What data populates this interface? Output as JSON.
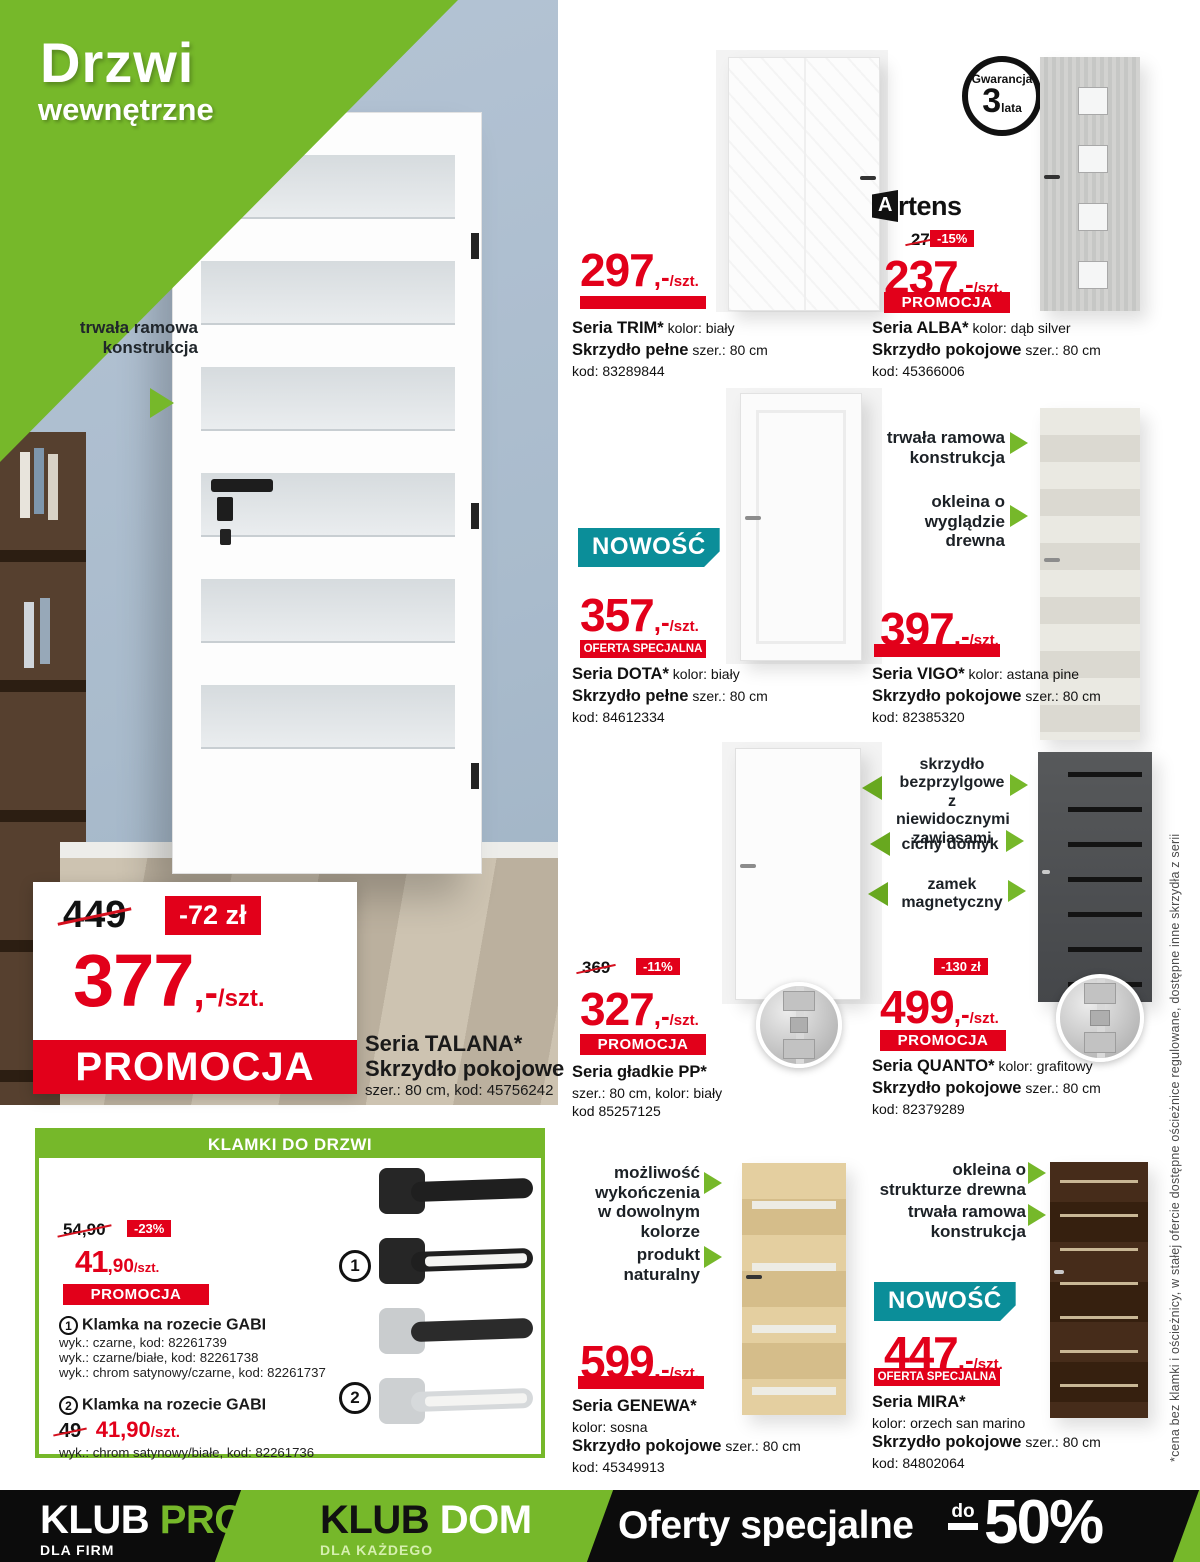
{
  "title": {
    "line1": "Drzwi",
    "line2": "wewnętrzne"
  },
  "colors": {
    "green": "#76B82A",
    "red": "#E2001A",
    "teal": "#0B8E99",
    "wall": "#AEBFD3",
    "footer": "#0C0C0C"
  },
  "hero": {
    "callout": "trwała ramowa konstrukcja",
    "old_price": "449",
    "discount": "-72 zł",
    "price": {
      "amount": "377",
      "dash": ",-",
      "unit": "/szt."
    },
    "promo_label": "PROMOCJA",
    "series": "Seria TALANA*",
    "series_line2": "Skrzydło pokojowe",
    "series_line3": "szer.: 80 cm, kod: 45756242"
  },
  "guarantee": {
    "top": "Gwarancja",
    "num": "3",
    "bottom": "lata"
  },
  "brand": {
    "mark": "A",
    "name": "rtens"
  },
  "products": {
    "trim": {
      "price": {
        "amount": "297",
        "dash": ",-",
        "unit": "/szt."
      },
      "l1b": "Seria TRIM*",
      "l1": "kolor: biały",
      "l2b": "Skrzydło pełne",
      "l2": "szer.: 80 cm",
      "l3": "kod: 83289844"
    },
    "alba": {
      "old": "279",
      "disc": "-15%",
      "price": {
        "amount": "237",
        "dash": ",-",
        "unit": "/szt."
      },
      "badge": "PROMOCJA",
      "l1b": "Seria ALBA*",
      "l1": "kolor: dąb silver",
      "l2b": "Skrzydło pokojowe",
      "l2": "szer.: 80 cm",
      "l3": "kod: 45366006"
    },
    "dota": {
      "new": "NOWOŚĆ",
      "price": {
        "amount": "357",
        "dash": ",-",
        "unit": "/szt."
      },
      "badge": "OFERTA SPECJALNA",
      "l1b": "Seria DOTA*",
      "l1": "kolor: biały",
      "l2b": "Skrzydło pełne",
      "l2": "szer.: 80 cm",
      "l3": "kod: 84612334"
    },
    "vigo": {
      "callout1": "trwała ramowa konstrukcja",
      "callout2": "okleina o wyglądzie drewna",
      "price": {
        "amount": "397",
        "dash": ",-",
        "unit": "/szt."
      },
      "l1b": "Seria VIGO*",
      "l1": "kolor: astana pine",
      "l2b": "Skrzydło pokojowe",
      "l2": "szer.: 80 cm",
      "l3": "kod: 82385320"
    },
    "pp": {
      "old": "369",
      "disc": "-11%",
      "price": {
        "amount": "327",
        "dash": ",-",
        "unit": "/szt."
      },
      "badge": "PROMOCJA",
      "l1b": "Seria gładkie PP*",
      "l2": "szer.: 80 cm, kolor: biały",
      "l3": "kod 85257125"
    },
    "quanto": {
      "callout1": "skrzydło bezprzylgowe z niewidocznymi zawiasami",
      "callout2": "cichy domyk",
      "callout3": "zamek magnetyczny",
      "old": "629",
      "disc": "-130 zł",
      "price": {
        "amount": "499",
        "dash": ",-",
        "unit": "/szt."
      },
      "badge": "PROMOCJA",
      "l1b": "Seria QUANTO*",
      "l1": "kolor: grafitowy",
      "l2b": "Skrzydło pokojowe",
      "l2": "szer.: 80 cm",
      "l3": "kod: 82379289"
    },
    "genewa": {
      "callout1": "możliwość wykończenia w dowolnym kolorze",
      "callout2": "produkt naturalny",
      "price": {
        "amount": "599",
        "dash": ",-",
        "unit": "/szt."
      },
      "l1b": "Seria GENEWA*",
      "l2": "kolor: sosna",
      "l3b": "Skrzydło pokojowe",
      "l3": "szer.: 80 cm",
      "l4": "kod: 45349913"
    },
    "mira": {
      "callout1": "okleina o strukturze drewna",
      "callout2": "trwała ramowa konstrukcja",
      "new": "NOWOŚĆ",
      "price": {
        "amount": "447",
        "dash": ",-",
        "unit": "/szt."
      },
      "badge": "OFERTA SPECJALNA",
      "l1b": "Seria MIRA*",
      "l2": "kolor: orzech san marino",
      "l3b": "Skrzydło pokojowe",
      "l3": "szer.: 80 cm",
      "l4": "kod: 84802064"
    }
  },
  "handles": {
    "header": "KLAMKI DO DRZWI",
    "old": "54,90",
    "disc": "-23%",
    "price": {
      "amount": "41",
      "dash": ",90",
      "unit": "/szt."
    },
    "badge": "PROMOCJA",
    "item1": {
      "num": "1",
      "title": "Klamka na rozecie GABI",
      "lines": [
        "wyk.: czarne, kod: 82261739",
        "wyk.: czarne/białe, kod: 82261738",
        "wyk.: chrom satynowy/czarne, kod: 82261737"
      ]
    },
    "item2": {
      "num": "2",
      "title": "Klamka na rozecie GABI",
      "old": "49",
      "price": "41,90",
      "unit": "/szt.",
      "line": "wyk.: chrom satynowy/białe, kod: 82261736"
    }
  },
  "footnote": "*cena bez klamki i ościeżnicy, w stałej ofercie dostępne ościeżnice regulowane, dostępne inne skrzydła z serii",
  "footer": {
    "pro": {
      "w1": "KLUB",
      "w2": "PRO",
      "sub": "DLA FIRM"
    },
    "dom": {
      "w1": "KLUB",
      "w2": "DOM",
      "sub": "DLA KAŻDEGO"
    },
    "offers": {
      "text": "Oferty specjalne",
      "do": "do",
      "percent": "50%"
    }
  }
}
